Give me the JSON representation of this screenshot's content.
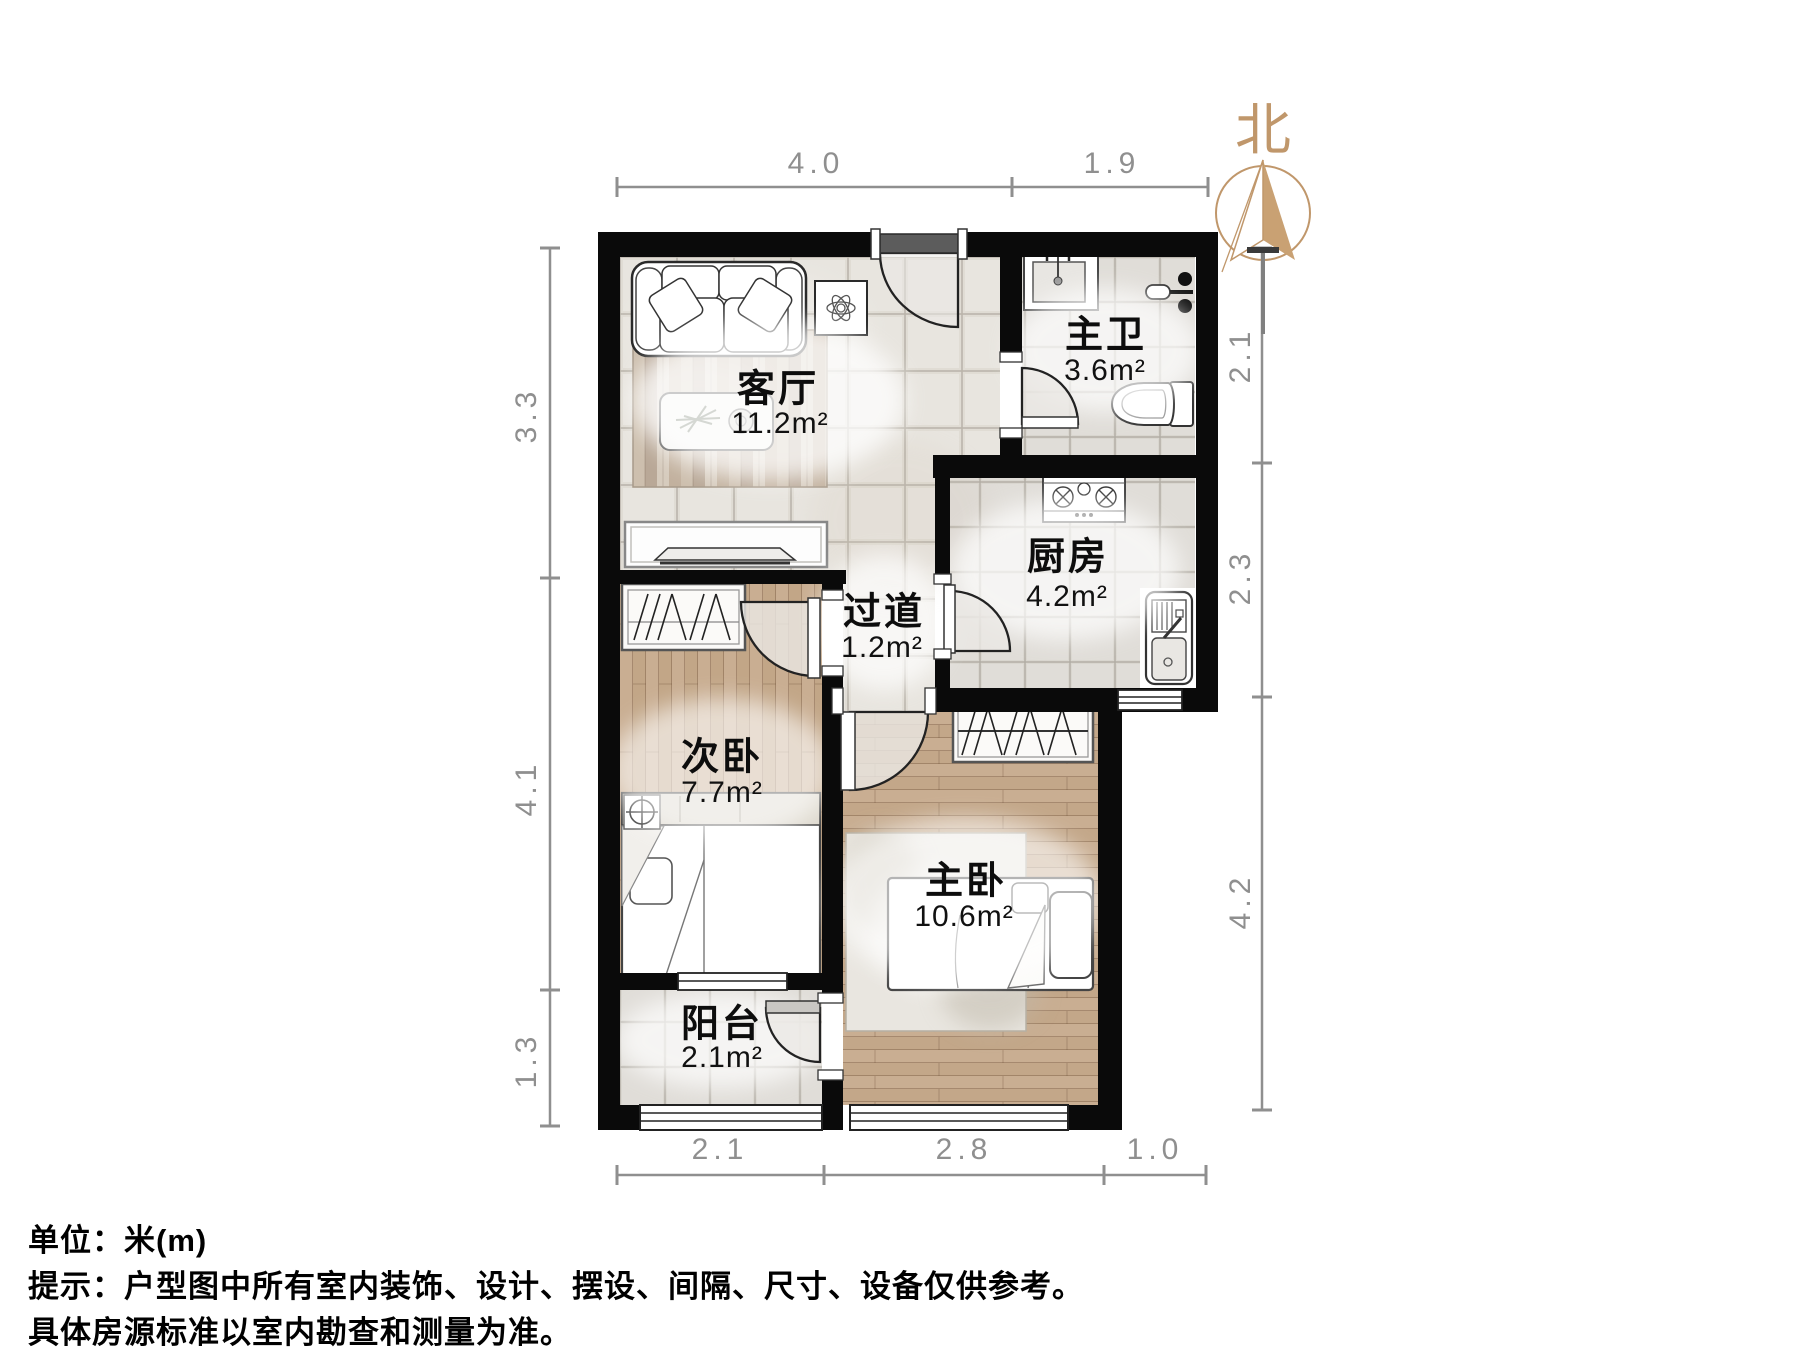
{
  "compass": {
    "north_label": "北"
  },
  "rooms": [
    {
      "id": "living-room",
      "name": "客厅",
      "area": "11.2m²"
    },
    {
      "id": "master-bath",
      "name": "主卫",
      "area": "3.6m²"
    },
    {
      "id": "kitchen",
      "name": "厨房",
      "area": "4.2m²"
    },
    {
      "id": "hallway",
      "name": "过道",
      "area": "1.2m²"
    },
    {
      "id": "second-bedroom",
      "name": "次卧",
      "area": "7.7m²"
    },
    {
      "id": "master-bedroom",
      "name": "主卧",
      "area": "10.6m²"
    },
    {
      "id": "balcony",
      "name": "阳台",
      "area": "2.1m²"
    }
  ],
  "dimensions": {
    "top": [
      "4.0",
      "1.9"
    ],
    "left": [
      "3.3",
      "4.1",
      "1.3"
    ],
    "right": [
      "2.1",
      "2.3",
      "4.2"
    ],
    "bottom": [
      "2.1",
      "2.8",
      "1.0"
    ]
  },
  "footer": {
    "unit_line": "单位：米(m)",
    "tip_line_1": "提示：户型图中所有室内装饰、设计、摆设、间隔、尺寸、设备仅供参考。",
    "tip_line_2": "具体房源标准以室内勘查和测量为准。"
  },
  "colors": {
    "wall": "#0a0a0a",
    "accent_tan": "#c0976b",
    "dim_gray": "#8f8f8f",
    "tile_large": "#e0dcd4",
    "tile_small": "#d9d6cf",
    "wood": "#c7ac90"
  }
}
